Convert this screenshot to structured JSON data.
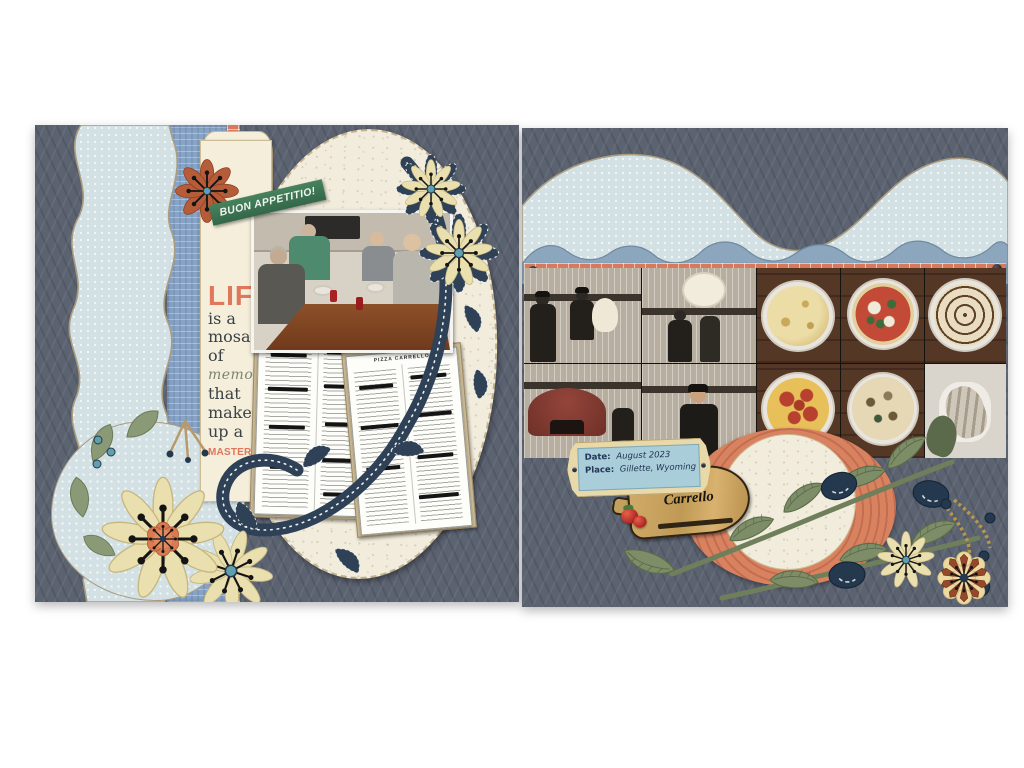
{
  "left_page": {
    "banner_text": "BUON APPETITIO!",
    "journal": {
      "l1": "LIFE",
      "l2": "is a",
      "l3": "mosaic",
      "l4": "of",
      "l5": "memories",
      "l6": "that",
      "l7": "make",
      "l8": "up a",
      "l9": "MASTERPIECE"
    },
    "menu_header": "PIZZA CARRELLO"
  },
  "right_page": {
    "plaque": {
      "date_label": "Date:",
      "date_value": "August 2023",
      "place_label": "Place:",
      "place_value": "Gillette, Wyoming"
    },
    "sign": {
      "line1": "Pizza",
      "line2": "Carrello"
    }
  },
  "colors": {
    "page_background": "#5b6270",
    "photo_backdrop": "#ffffff",
    "light_blue_paper": "#d3e1e5",
    "script_blue_paper": "#87a3c6",
    "scallop_blue_paper": "#8ba6bd",
    "brick_orange": "#d8795b",
    "cream_card": "#f4eeda",
    "coral_text": "#e0765a",
    "banner_green": "#3f7a55",
    "navy_accent": "#2e4156",
    "leaf_green": "#7d8d68",
    "wood_tan": "#c9a365",
    "rust": "#b65c38"
  }
}
